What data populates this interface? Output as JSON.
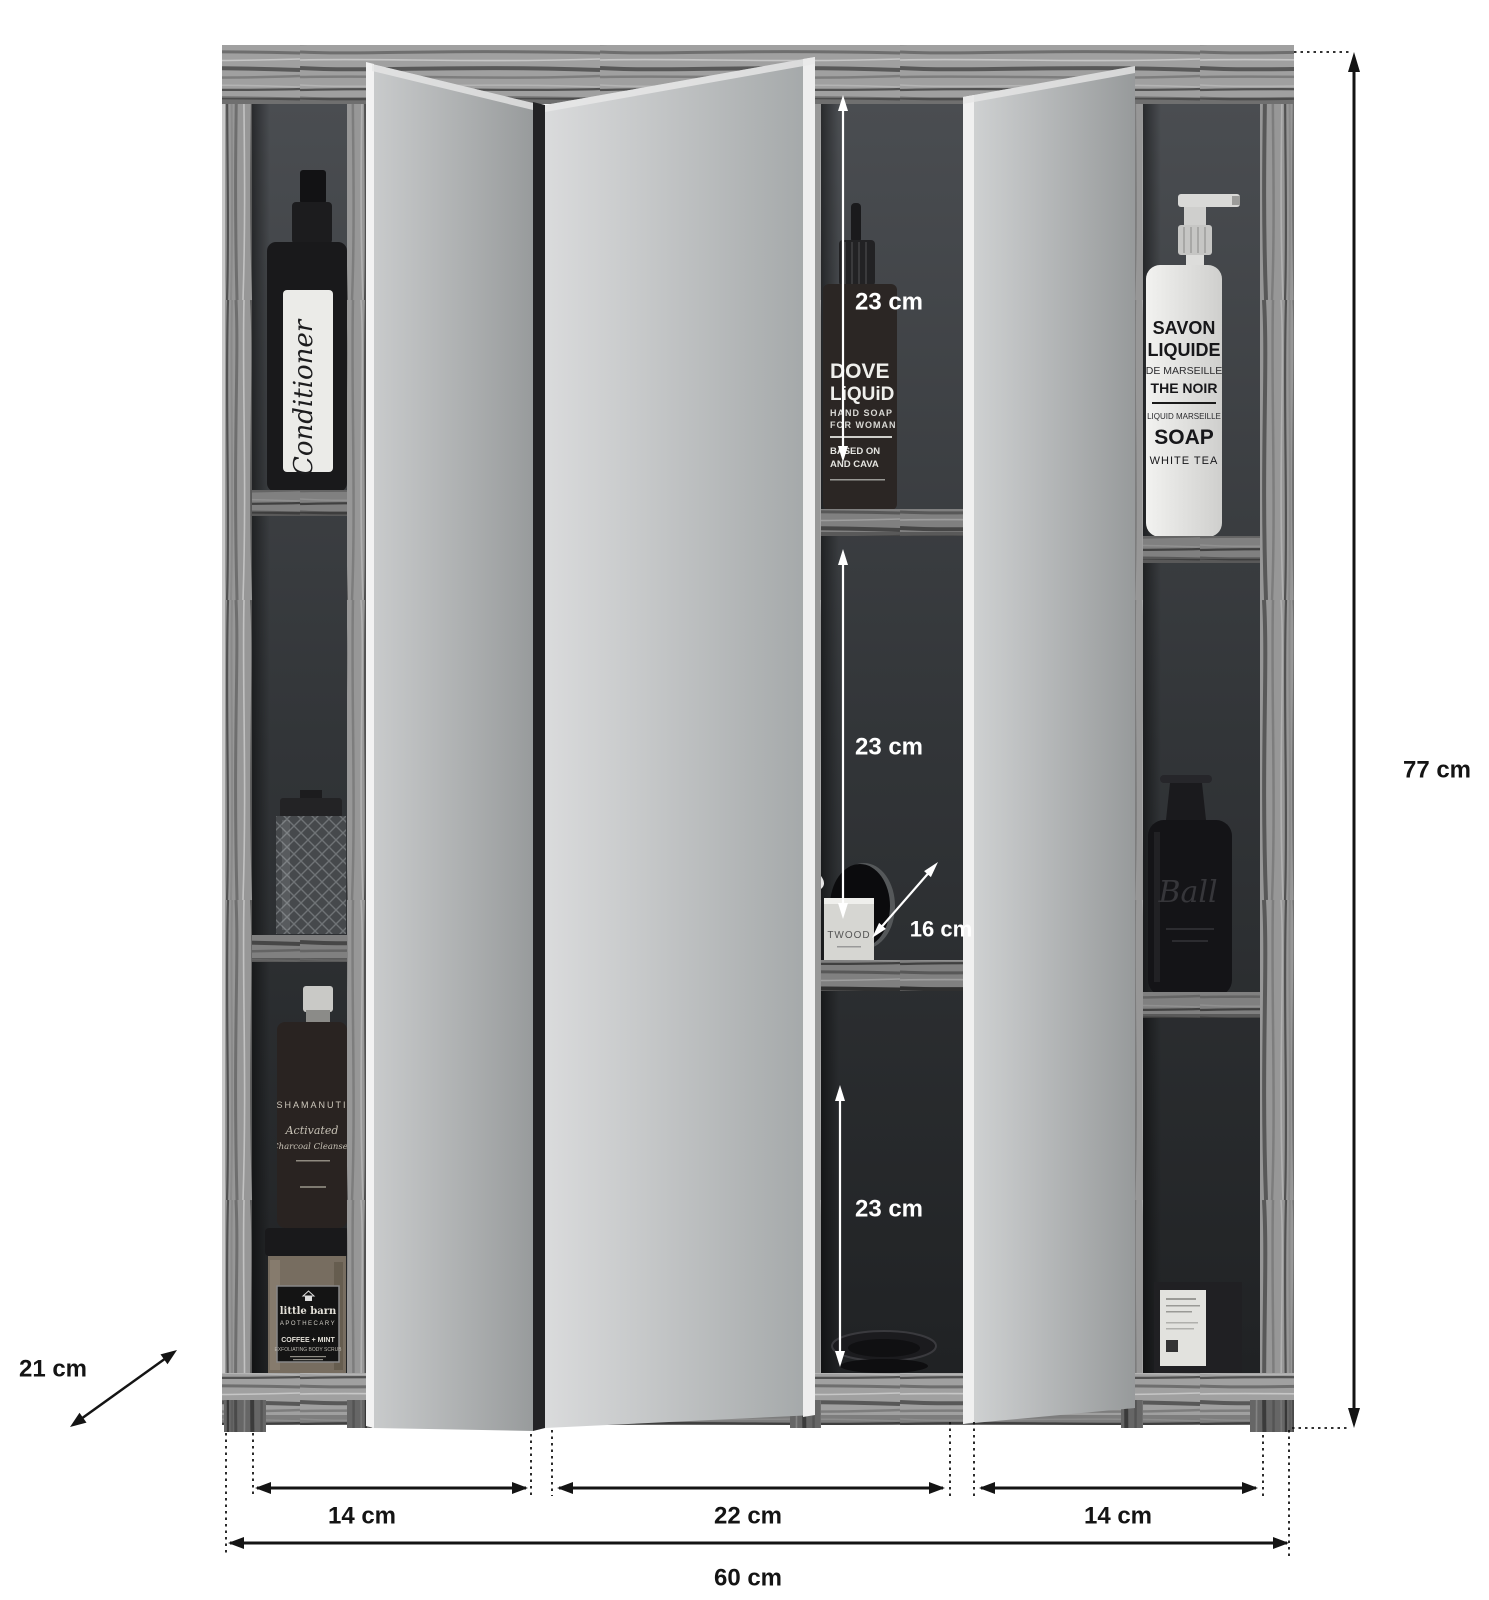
{
  "diagram": {
    "title": "mirror-cabinet-dimension-diagram",
    "dims": {
      "height": "77 cm",
      "width_total": "60 cm",
      "depth": "21 cm",
      "left_door": "14 cm",
      "center_door": "22 cm",
      "right_door": "14 cm",
      "compartment_top": "23 cm",
      "compartment_middle": "23 cm",
      "compartment_bottom": "23 cm",
      "cutout": "16 cm"
    },
    "products": {
      "conditioner_label": "Conditioner",
      "dropper_bottle": {
        "l1": "DOVE",
        "l2": "LiQUiD",
        "l3": "HAND SOAP",
        "l4": "FOR WOMAN",
        "l5": "BASED ON",
        "l6": "AND CAVA"
      },
      "soap_dispenser": {
        "l1": "SAVON",
        "l2": "LIQUIDE",
        "l3": "DE MARSEILLE",
        "l4": "THE NOIR",
        "l5": "LIQUID MARSEILLE",
        "l6": "SOAP",
        "l7": "WHITE TEA"
      },
      "cleanser_bottle": {
        "l1": "SHAMANUTI",
        "l2": "Activated",
        "l3": "Charcoal Cleanser"
      },
      "scrub_jar": {
        "l1": "little barn",
        "l2": "APOTHECARY",
        "l3": "COFFEE + MINT",
        "l4": "EXFOLIATING BODY SCRUB"
      },
      "candle_jar": "TWOOD",
      "black_bottle": "Ball"
    },
    "colors": {
      "background": "#ffffff",
      "wood": "#9a9a9a",
      "mirror": "#c6c8c9",
      "annotation_dark": "#141414",
      "annotation_light": "#ffffff"
    }
  }
}
